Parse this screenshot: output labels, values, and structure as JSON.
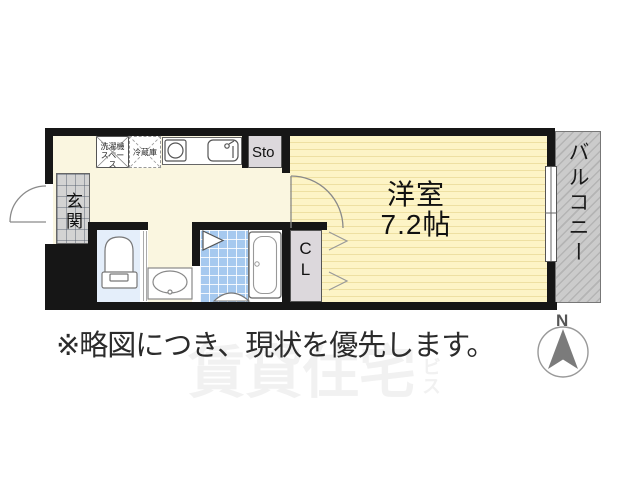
{
  "floorplan": {
    "rooms": {
      "entrance": "玄関",
      "western_room": "洋室",
      "western_room_size": "7.2帖",
      "balcony": "バルコニー",
      "storage": "Sto",
      "closet": "CL",
      "washer_space_line1": "洗濯機",
      "washer_space_line2": "スペース",
      "refrigerator": "冷蔵庫"
    },
    "fixtures": [
      "toilet",
      "washbasin",
      "bathtub",
      "stove",
      "sink",
      "washer-space",
      "refrigerator"
    ]
  },
  "note": "※略図につき、現状を優先します。",
  "compass": {
    "north_label": "N"
  },
  "watermark": {
    "text_large": "賃貸住宅",
    "text_small": "ビス"
  },
  "colors": {
    "wall": "#161616",
    "floor_cream": "#faf6e0",
    "room_yellow": "#fdf4c6",
    "room_stripe": "#eee0a2",
    "bath_tile_blue": "#a6c9ef",
    "toilet_blue": "#e4eefa",
    "storage_gray": "#dcd8dc",
    "entrance_gray": "#d3d3d3",
    "balcony_gray": "#cbcbcb",
    "compass_arrow": "#7b7b7b",
    "watermark_gray": "#f1f1f1"
  }
}
